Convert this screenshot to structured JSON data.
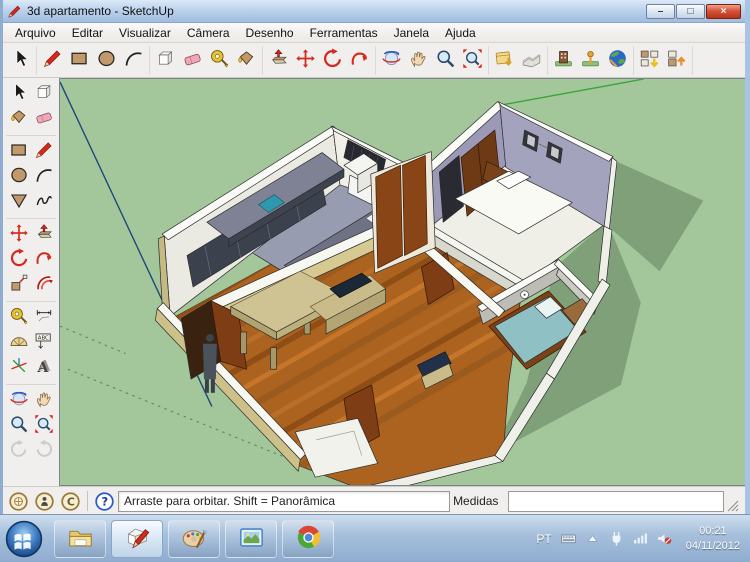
{
  "window": {
    "title": "3d apartamento - SketchUp",
    "controls": {
      "minimize": "–",
      "maximize": "□",
      "close": "×"
    }
  },
  "menu": {
    "items": [
      "Arquivo",
      "Editar",
      "Visualizar",
      "Câmera",
      "Desenho",
      "Ferramentas",
      "Janela",
      "Ajuda"
    ]
  },
  "toolbar_top": {
    "groups": [
      [
        "select"
      ],
      [
        "line",
        "rectangle",
        "circle",
        "arc"
      ],
      [
        "make-component",
        "eraser",
        "tape-measure",
        "paint-bucket"
      ],
      [
        "push-pull",
        "move",
        "rotate",
        "follow-me"
      ],
      [
        "orbit",
        "pan",
        "zoom",
        "zoom-extents"
      ],
      [
        "add-location",
        "toggle-terrain"
      ],
      [
        "photo-textures",
        "model-pin",
        "google-earth"
      ],
      [
        "get-models",
        "share-model"
      ]
    ]
  },
  "toolbar_left": {
    "rows": [
      [
        "select",
        "make-component"
      ],
      [
        "paint-bucket",
        "eraser"
      ],
      [
        "rectangle",
        "line"
      ],
      [
        "circle",
        "arc"
      ],
      [
        "polygon",
        "freehand"
      ],
      [
        "move",
        "push-pull"
      ],
      [
        "rotate",
        "follow-me"
      ],
      [
        "scale",
        "offset"
      ],
      [
        "tape-measure",
        "dimension"
      ],
      [
        "protractor",
        "text"
      ],
      [
        "axes",
        "text-3d"
      ],
      [
        "orbit",
        "pan"
      ],
      [
        "zoom",
        "zoom-extents"
      ],
      [
        "previous",
        "next"
      ]
    ],
    "disabled": [
      "previous",
      "next"
    ]
  },
  "statusbar": {
    "icons": [
      "geolocation",
      "credits",
      "copyright"
    ],
    "hint": "Arraste para orbitar. Shift = Panorâmica",
    "measurements_label": "Medidas",
    "measurements_value": ""
  },
  "taskbar": {
    "apps": [
      "explorer",
      "sketchup",
      "paint",
      "photo-viewer",
      "chrome"
    ],
    "active_app": "sketchup",
    "tray": {
      "language": "PT",
      "icons": [
        "keyboard",
        "tray-expand",
        "power",
        "network",
        "volume-muted"
      ],
      "time": "00:21",
      "date": "04/11/2012"
    }
  },
  "viewport": {
    "background_color": "#A3C69B",
    "shadow_color": "#7FA078",
    "axis_blue": "#1F4878",
    "axis_green": "#3AA33A"
  }
}
